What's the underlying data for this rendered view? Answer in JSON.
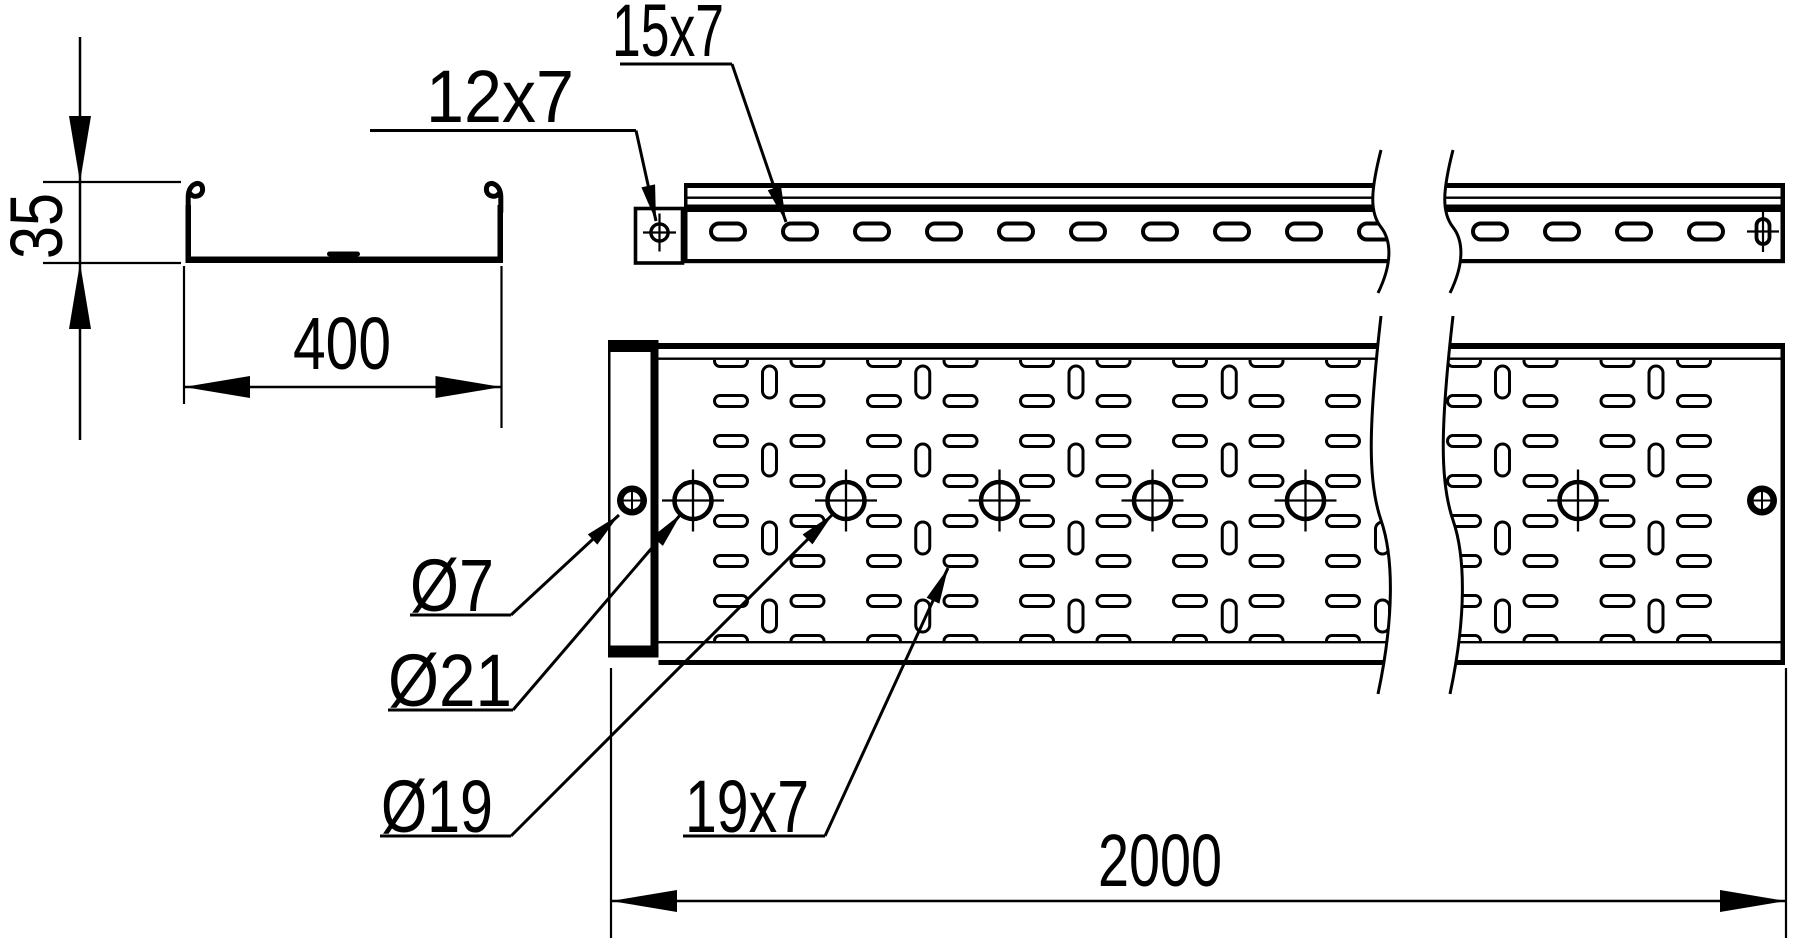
{
  "labels": {
    "profile_height": "35",
    "profile_width": "400",
    "tray_length": "2000",
    "end_plate_hole": "12x7",
    "side_wall_slot": "15x7",
    "connector_hole": "Ø7",
    "center_hole": "Ø21",
    "mid_hole": "Ø19",
    "bottom_slot": "19x7"
  },
  "geometry": {
    "canvas": {
      "w": 1800,
      "h": 941
    },
    "cross_section": {
      "wall_left_x": 185.5,
      "wall_right_x": 497.5,
      "wall_w": 5.5,
      "wall_top_y": 205,
      "wall_bot_y": 263,
      "floor_x1": 185.5,
      "floor_x2": 503,
      "floor_y": 256.5,
      "floor_h": 6.5,
      "rib": {
        "x": 327,
        "w": 33,
        "y": 251.5,
        "h": 5
      },
      "curl_left": "M188.2,212 L188.2,197 C188.2,182 202.6,179.5 202.6,189.3 C202.6,196.8 193.2,198.2 190.2,193.6",
      "curl_right": "M500.8,212 L500.8,197 C500.8,182 486.4,179.5 486.4,189.3 C486.4,196.8 495.8,198.2 498.8,193.6",
      "dim35": {
        "line_x": 80,
        "line_y1": 37,
        "line_y2": 440,
        "tick_x1": 43,
        "tick_x2": 181,
        "tick_y1": 182,
        "tick_y2": 263,
        "text_x": 62,
        "text_y": 226,
        "text_len": 66
      },
      "dim400": {
        "y": 387,
        "x1": 184,
        "x2": 501.5,
        "ext_y1": 266,
        "ext_y2l": 404,
        "ext_y2r": 428,
        "text_x": 342,
        "text_y": 369,
        "text_len": 98
      }
    },
    "side_view": {
      "x1": 684,
      "x2": 1785,
      "top_y": 183,
      "top_h": 5,
      "thin_y": 196.5,
      "thin_h": 2.4,
      "band_y": 204.5,
      "band_h": 7.5,
      "bot_y": 259,
      "bot_h": 4.2,
      "plate": {
        "x": 635.5,
        "y": 208.5,
        "w": 47,
        "h": 54.5
      },
      "plate_hole": {
        "cx": 659.5,
        "cy": 232.5,
        "r": 8.6
      },
      "slot_y": 231.5,
      "slot_w": 34,
      "slot_h": 16,
      "slots_x": [
        728,
        800,
        872,
        944,
        1016,
        1088,
        1160,
        1232,
        1304,
        1376,
        1490,
        1562,
        1634,
        1706
      ],
      "end_slot": {
        "cx": 1763,
        "cy": 231.5,
        "w": 13,
        "h": 25
      },
      "brk": {
        "x1": 1381,
        "x2": 1453,
        "y0": 150,
        "y1": 293,
        "a": 11
      }
    },
    "top_view": {
      "x1": 658.5,
      "x2": 1785,
      "outer_top_y": 343,
      "outer_top_h": 6,
      "inner_top_y": 357.5,
      "inner_h": 2.4,
      "inner_bot_y": 641,
      "outer_bot_y": 660,
      "outer_bot_h": 5,
      "bottom": 665,
      "plate": {
        "x": 608,
        "y": 340,
        "w": 50.5,
        "h": 317.5,
        "bar_h": 12,
        "right_bar_w": 8
      },
      "hole7_left": {
        "cx": 632,
        "cy": 500.5
      },
      "hole7_right": {
        "cx": 1762,
        "cy": 500.5
      },
      "h_slot": {
        "w": 33,
        "h": 11
      },
      "v_slot": {
        "w": 14,
        "h": 32
      },
      "h_cols": [
        731,
        807.5,
        884,
        960.5,
        1037,
        1113.5,
        1190,
        1266.5,
        1343,
        1464,
        1540.5,
        1617.5,
        1694
      ],
      "h_rows": [
        361,
        401,
        441,
        481,
        521,
        561,
        601,
        641
      ],
      "v_cols": [
        769.5,
        922.75,
        1076,
        1229.25,
        1382.5,
        1502.5,
        1656
      ],
      "v_rows": [
        382,
        460,
        538,
        616
      ],
      "holes21_x": [
        693,
        846,
        999.5,
        1152.5,
        1305.5,
        1578
      ],
      "holes_y": 500.5,
      "brk": {
        "x1": 1381,
        "x2": 1453,
        "y0": 316,
        "y1": 694,
        "a": 13
      }
    },
    "dim2000": {
      "y": 901,
      "x1": 611,
      "x2": 1786,
      "ext_y1": 668,
      "ext_y2": 938,
      "text_x": 1160,
      "text_y": 886,
      "text_len": 124
    },
    "leaders": [
      {
        "name": "label-12x7",
        "bind": "labels.end_plate_hole",
        "tx": 500,
        "ty": 122,
        "tl": 148,
        "ux1": 370,
        "ux2": 636,
        "uy": 130.5,
        "tipx": 656,
        "tipy": 221
      },
      {
        "name": "label-15x7",
        "bind": "labels.side_wall_slot",
        "tx": 668,
        "ty": 56,
        "tl": 112,
        "ux1": 620,
        "ux2": 732,
        "uy": 64,
        "tipx": 786,
        "tipy": 222
      },
      {
        "name": "label-dia7",
        "bind": "labels.connector_hole",
        "tx": 452,
        "ty": 611,
        "tl": 84,
        "ux1": 410,
        "ux2": 511,
        "uy": 615,
        "tipx": 619,
        "tipy": 515
      },
      {
        "name": "label-dia21",
        "bind": "labels.center_hole",
        "tx": 450,
        "ty": 706,
        "tl": 124,
        "ux1": 388,
        "ux2": 513,
        "uy": 710,
        "tipx": 681,
        "tipy": 514
      },
      {
        "name": "label-dia19",
        "bind": "labels.mid_hole",
        "tx": 437,
        "ty": 832,
        "tl": 112,
        "ux1": 380,
        "ux2": 511,
        "uy": 836,
        "tipx": 833,
        "tipy": 514
      },
      {
        "name": "label-19x7",
        "bind": "labels.bottom_slot",
        "tx": 747,
        "ty": 832,
        "tl": 124,
        "ux1": 683,
        "ux2": 825,
        "uy": 836,
        "tipx": 948,
        "tipy": 568
      }
    ]
  }
}
